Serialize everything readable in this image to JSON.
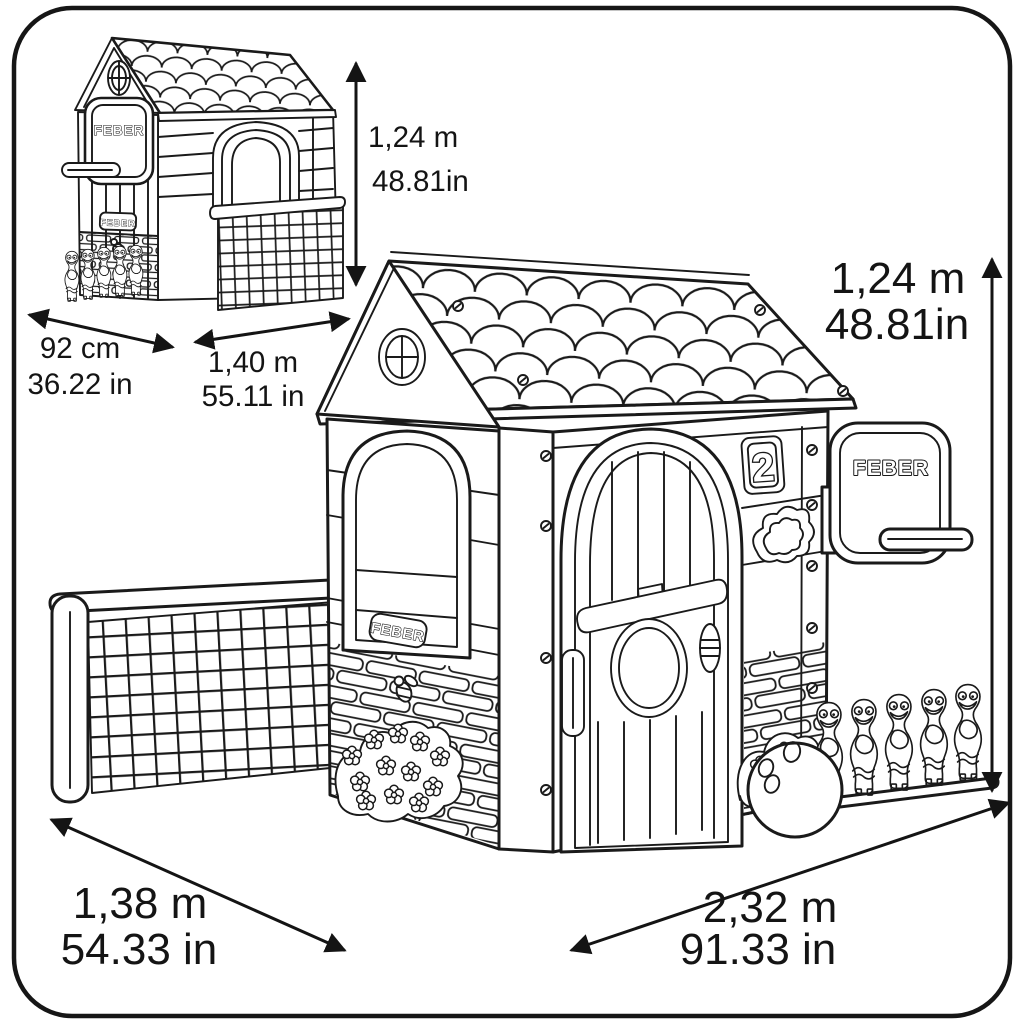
{
  "page": {
    "background": "#ffffff",
    "border_color": "#161616"
  },
  "branding": {
    "logo_text": "FEBER",
    "house_number_plaque": "2"
  },
  "views": {
    "back_view": {
      "height": {
        "metric": "1,24 m",
        "imperial": "48.81in"
      },
      "depth": {
        "metric": "92 cm",
        "imperial": "36.22 in"
      },
      "width": {
        "metric": "1,40 m",
        "imperial": "55.11 in"
      }
    },
    "front_view": {
      "height": {
        "metric": "1,24 m",
        "imperial": "48.81in"
      },
      "footprint_depth": {
        "metric": "1,38 m",
        "imperial": "54.33 in"
      },
      "footprint_width": {
        "metric": "2,32 m",
        "imperial": "91.33 in"
      }
    }
  },
  "drawing": {
    "subject": "FEBER multi-activity kids playhouse dimensional line drawing",
    "features": [
      "shingled roof",
      "round gable window",
      "arched window",
      "door with porthole",
      "number 2 plaque",
      "basketball backboard and hoop",
      "bowling pins",
      "bowling ball",
      "soccer goal with net",
      "brick base",
      "flower bushes",
      "bee"
    ]
  }
}
